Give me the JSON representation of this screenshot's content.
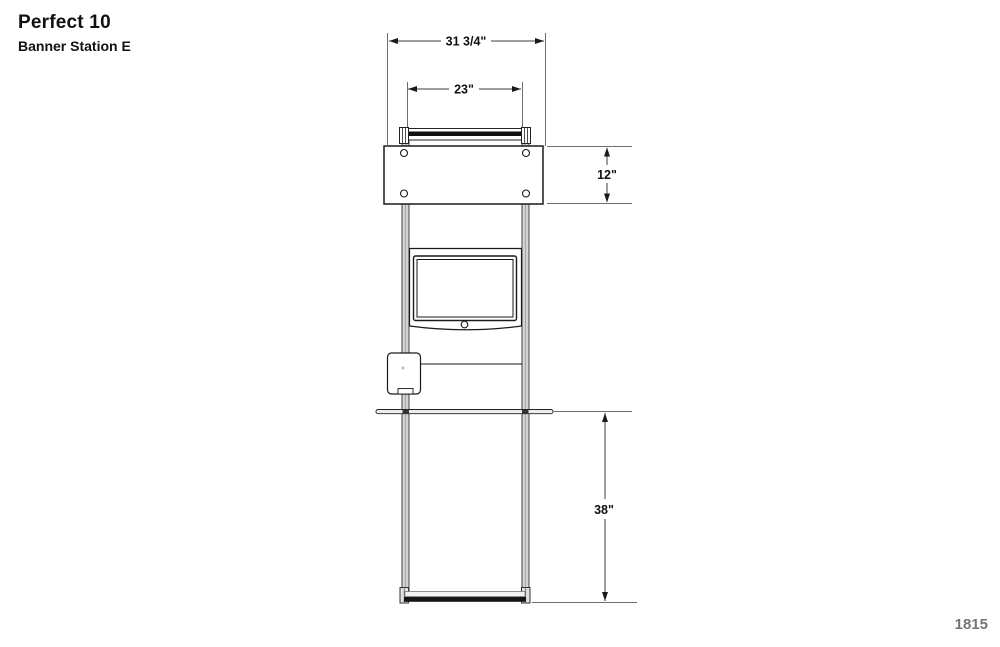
{
  "page": {
    "title": "Perfect 10",
    "subtitle": "Banner Station E",
    "page_number": "1815"
  },
  "drawing": {
    "view": "banner-station-front-elevation",
    "dimensions": {
      "overall_width": "31 3/4\"",
      "header_bar_width": "23\"",
      "header_panel_height": "12\"",
      "counter_height": "38\""
    },
    "components": [
      "header-bar",
      "header-panel",
      "left-post",
      "right-post",
      "monitor-enclosure",
      "monitor-screen",
      "card-reader-box",
      "shelf-counter",
      "base-foot-rail"
    ],
    "colors": {
      "object_line": "#1a1a1a",
      "dimension_line": "#3c3c3c",
      "extension_line": "#6e6e6e",
      "post_fill": "#d4d4d4",
      "dark_fill": "#141414",
      "page_number_text": "#757575",
      "background": "#ffffff"
    }
  }
}
